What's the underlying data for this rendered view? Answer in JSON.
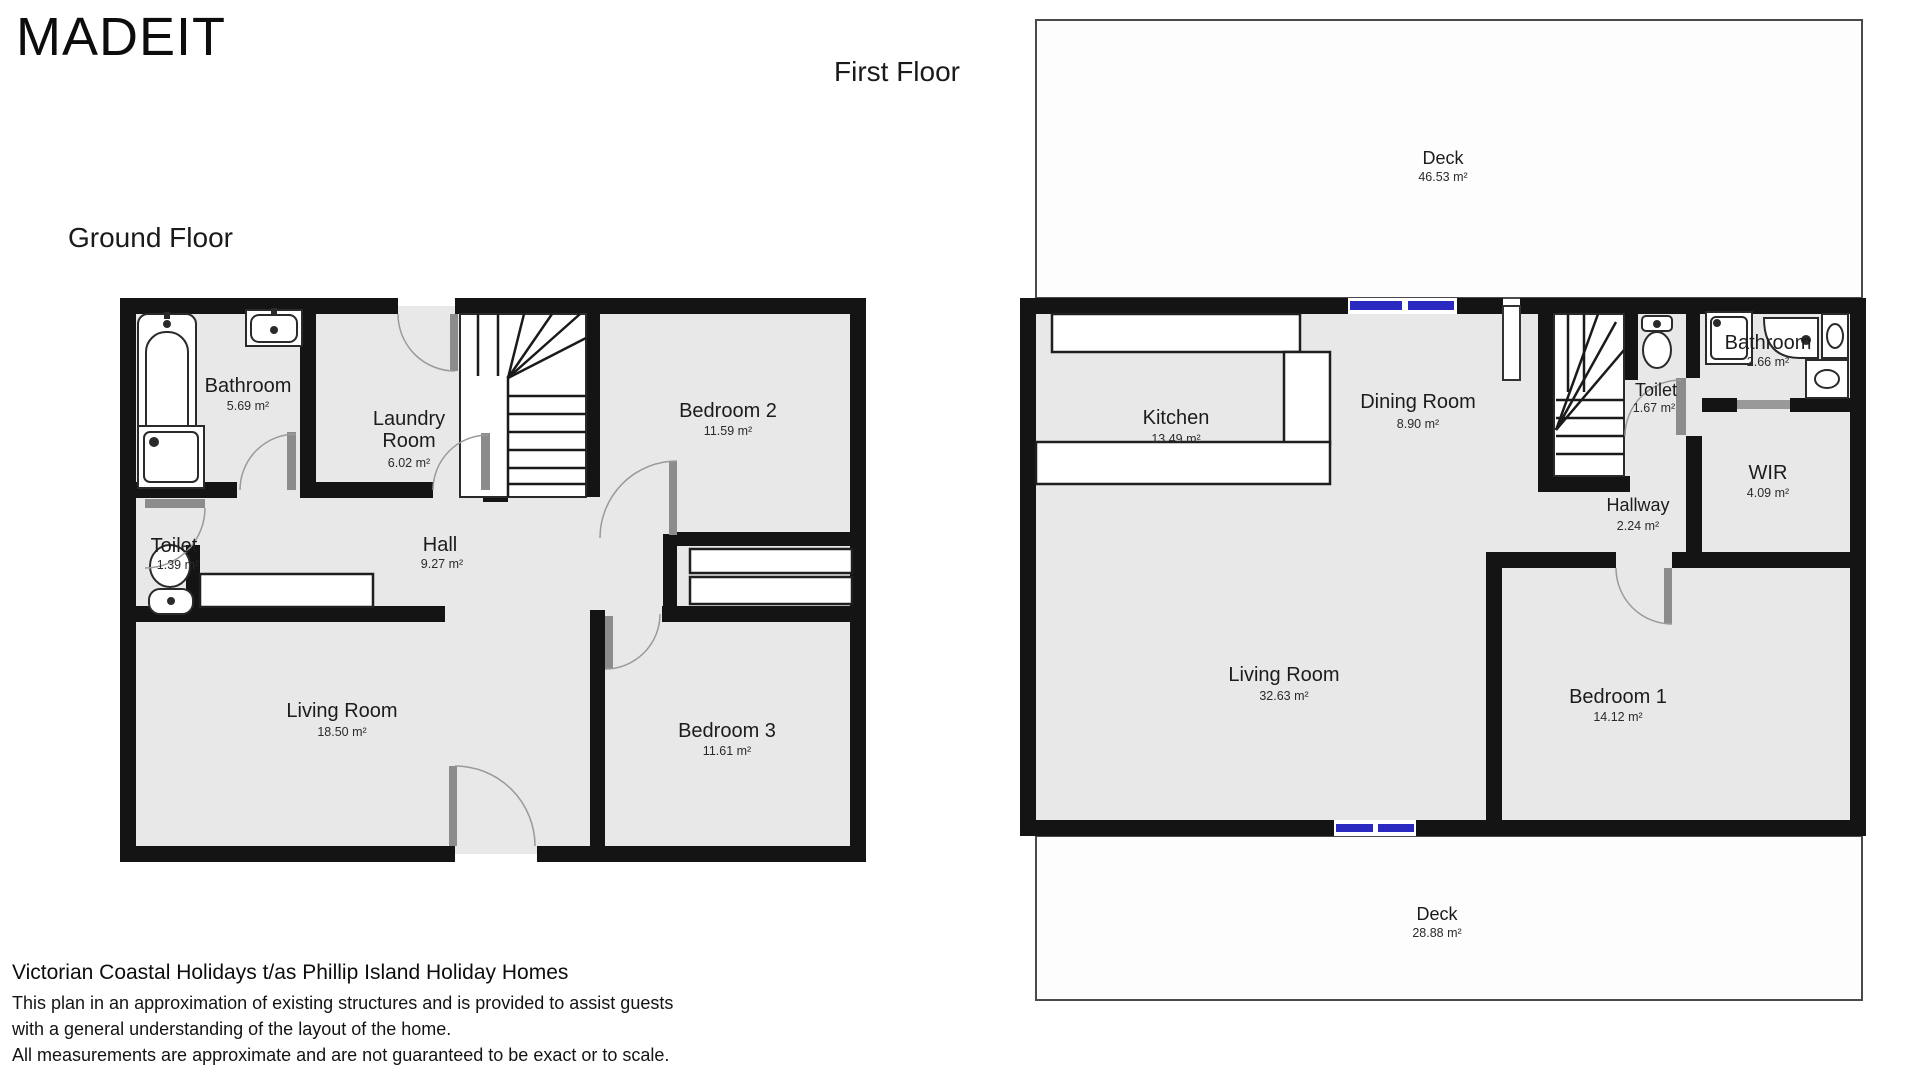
{
  "title": "MADEIT",
  "ground_floor": {
    "heading": "Ground Floor",
    "rooms": {
      "bathroom": {
        "name": "Bathroom",
        "area": "5.69 m²"
      },
      "laundry": {
        "name_line1": "Laundry",
        "name_line2": "Room",
        "area": "6.02 m²"
      },
      "bedroom2": {
        "name": "Bedroom 2",
        "area": "11.59 m²"
      },
      "toilet": {
        "name": "Toilet",
        "area": "1.39 m²"
      },
      "hall": {
        "name": "Hall",
        "area": "9.27 m²"
      },
      "living": {
        "name": "Living Room",
        "area": "18.50 m²"
      },
      "bedroom3": {
        "name": "Bedroom 3",
        "area": "11.61 m²"
      }
    }
  },
  "first_floor": {
    "heading": "First Floor",
    "rooms": {
      "deck_top": {
        "name": "Deck",
        "area": "46.53 m²"
      },
      "kitchen": {
        "name": "Kitchen",
        "area": "13.49 m²"
      },
      "dining": {
        "name": "Dining Room",
        "area": "8.90 m²"
      },
      "toilet": {
        "name": "Toilet",
        "area": "1.67 m²"
      },
      "bathroom": {
        "name": "Bathroom",
        "area": "2.66 m²"
      },
      "wir": {
        "name": "WIR",
        "area": "4.09 m²"
      },
      "hallway": {
        "name": "Hallway",
        "area": "2.24 m²"
      },
      "living": {
        "name": "Living Room",
        "area": "32.63 m²"
      },
      "bedroom1": {
        "name": "Bedroom 1",
        "area": "14.12 m²"
      },
      "deck_bottom": {
        "name": "Deck",
        "area": "28.88 m²"
      }
    }
  },
  "footer": {
    "company": "Victorian Coastal Holidays t/as Phillip Island Holiday Homes",
    "disclaimer_line1": "This plan in an approximation of existing structures and is provided to assist guests",
    "disclaimer_line2": "with a general understanding of the layout of the home.",
    "disclaimer_line3": "All measurements are approximate and are not guaranteed to be exact or to scale."
  },
  "colors": {
    "wall": "#141414",
    "room_fill": "#e8e8e8",
    "window_blue": "#2a2ac0"
  }
}
